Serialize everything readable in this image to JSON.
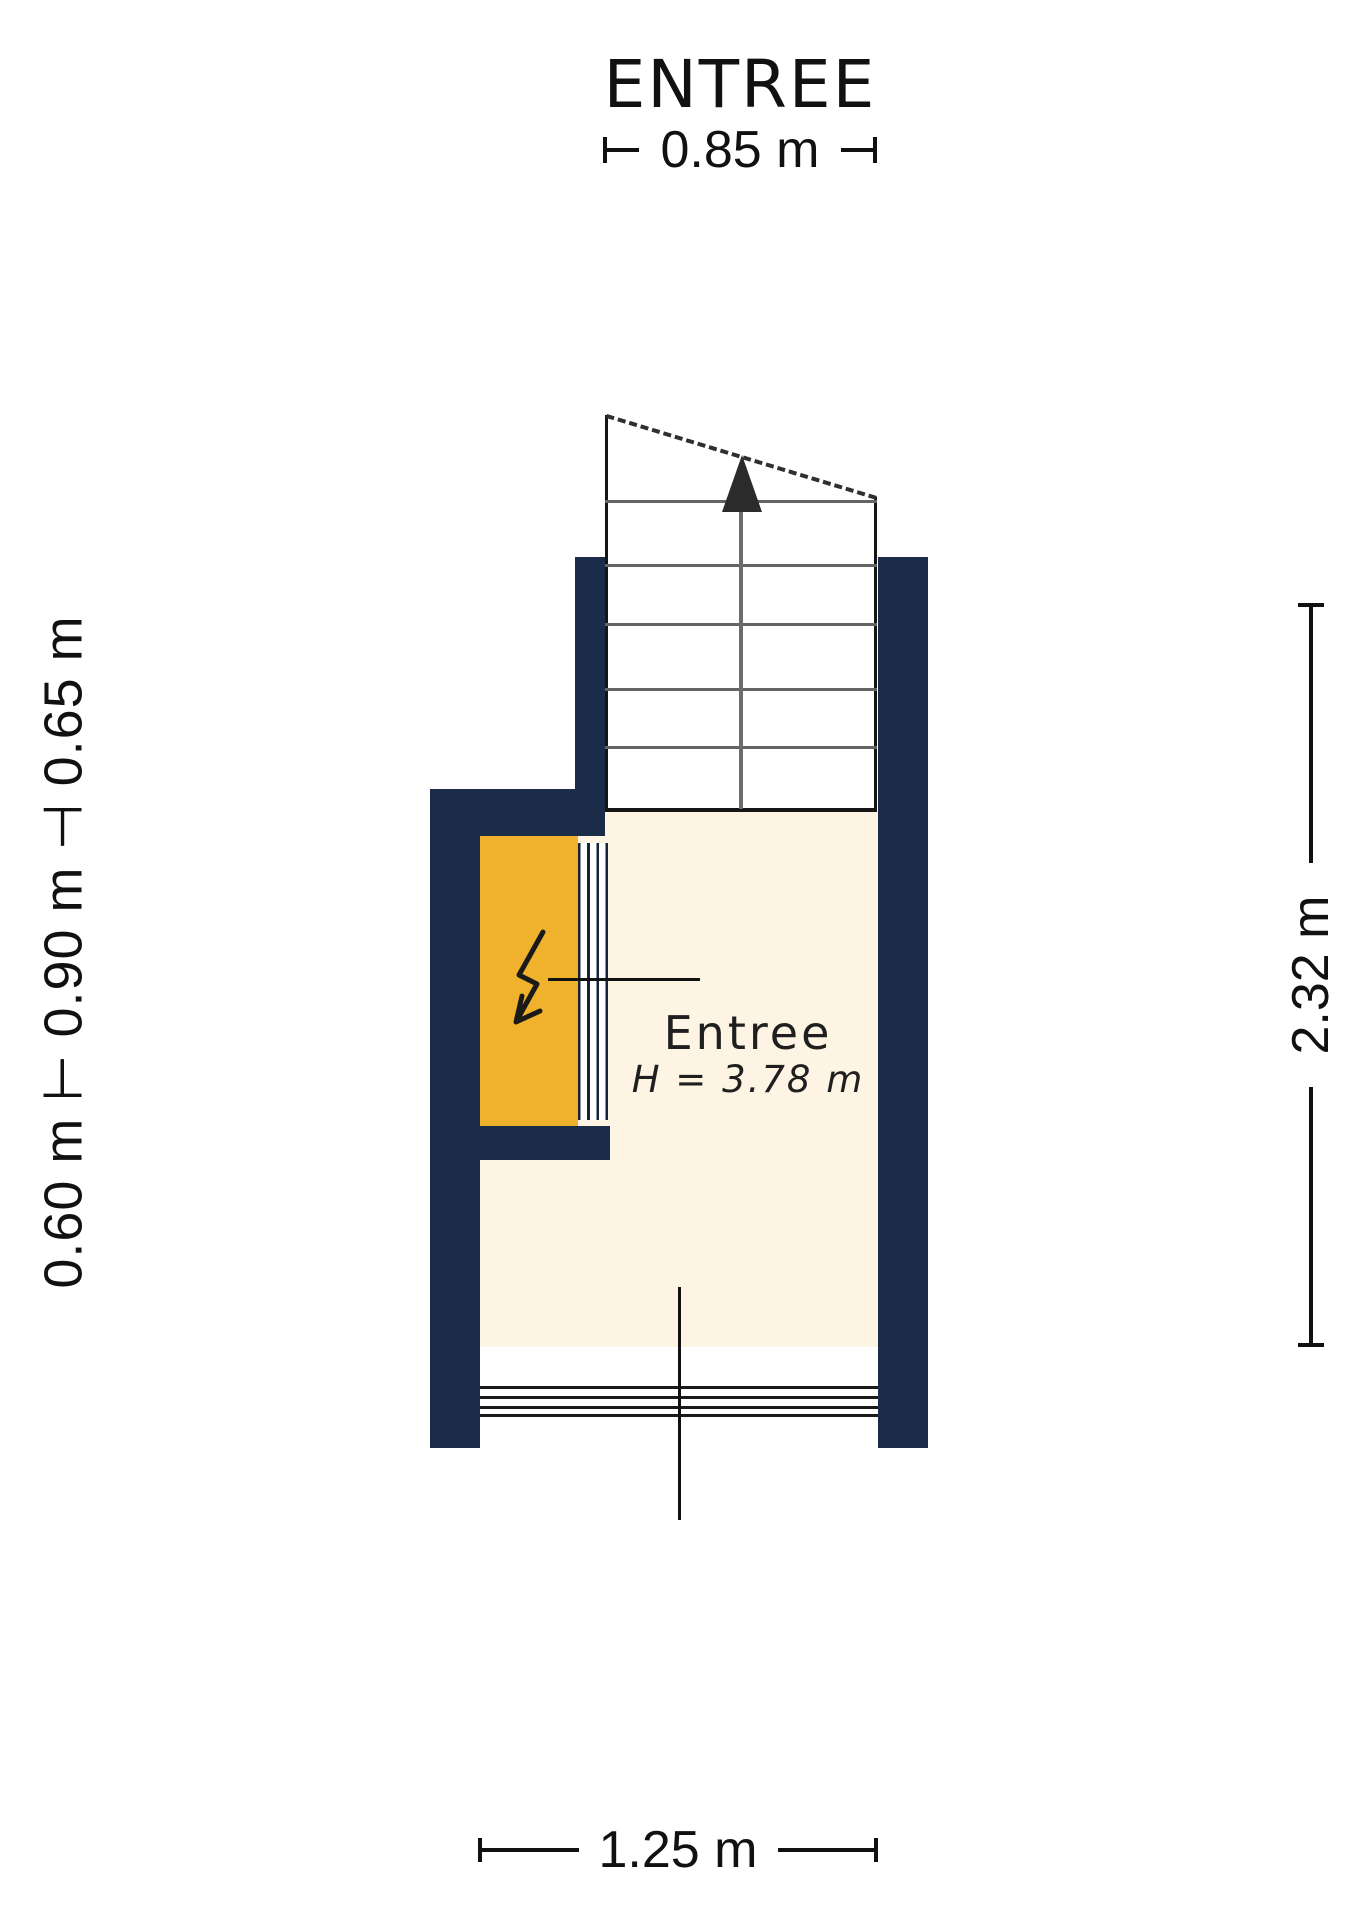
{
  "title": "ENTREE",
  "dimensions": {
    "top": "0.85 m",
    "left": "0.60 m ⊢ 0.90 m ⊣ 0.65 m",
    "right": "2.32 m",
    "bottom": "1.25 m"
  },
  "room": {
    "name": "Entree",
    "height_label": "H = 3.78 m"
  },
  "icons": {
    "stairs_arrow": "up-arrow",
    "meter_cabinet": "lightning-bolt"
  },
  "colors": {
    "wall": "#1b2c49",
    "floor": "#fdf4e3",
    "cabinet": "#f0b22c",
    "line": "#1a1a1a",
    "tread": "#646464"
  }
}
